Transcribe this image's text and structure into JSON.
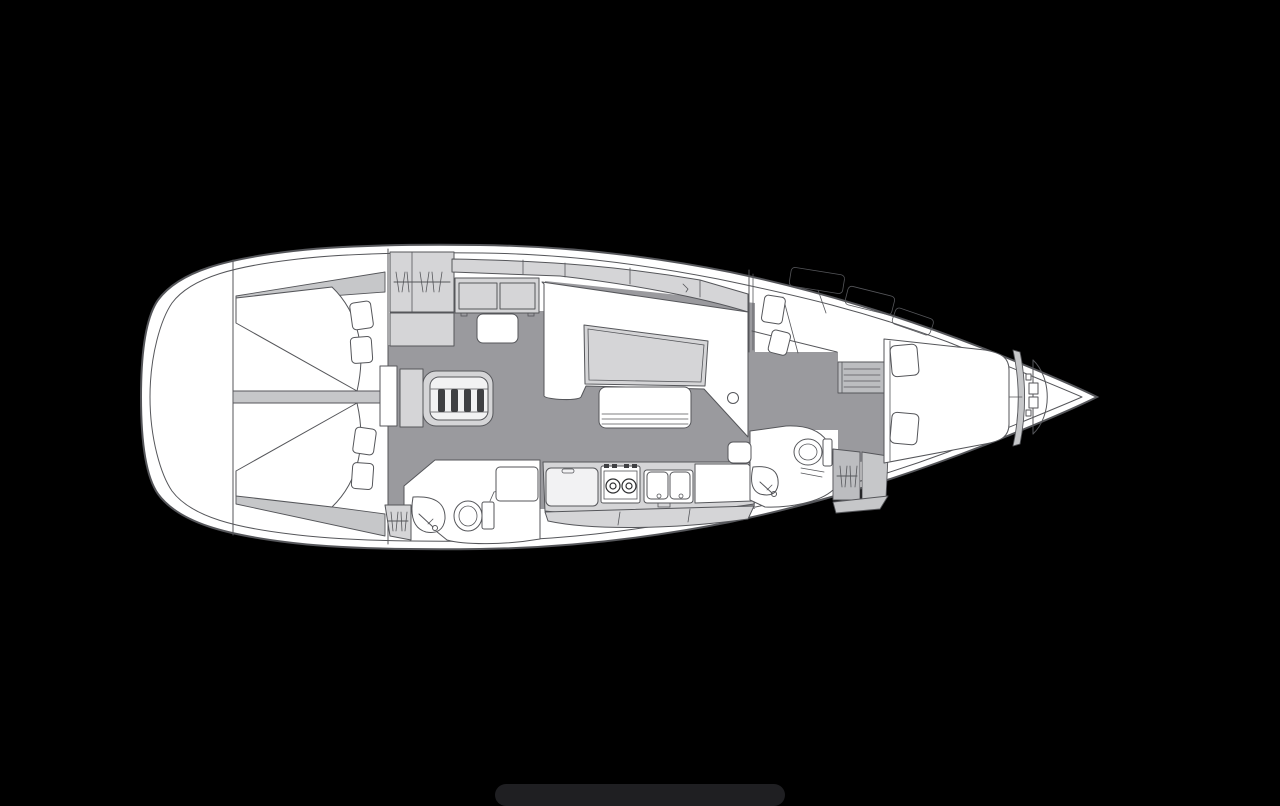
{
  "app": {
    "title": "Sailboat interior layout plan — top view, bow facing right"
  },
  "canvas": {
    "width": 1280,
    "height": 806,
    "background": "#000000"
  },
  "colors": {
    "bg": "#000000",
    "hull": "#ffffff",
    "line": "#55565a",
    "line-soft": "#8a8b8e",
    "floor": "#9a9a9e",
    "furn": "#d5d5d7",
    "panel": "#c6c7c9",
    "shelf": "#bcbdc0",
    "tread": "#3f4043",
    "inner": "#f2f2f3",
    "shadow": "#1f1f22"
  },
  "orientation": {
    "bow": "right",
    "stern": "left",
    "port": "top",
    "starboard": "bottom"
  },
  "rooms": [
    {
      "id": "stern-lazarette",
      "label": "stern locker / transom"
    },
    {
      "id": "aft-cabin-port",
      "label": "aft double cabin (port)"
    },
    {
      "id": "aft-cabin-starboard",
      "label": "aft double cabin (starboard)"
    },
    {
      "id": "aft-head",
      "label": "aft head with toilet and washbasin"
    },
    {
      "id": "salon",
      "label": "salon with L-settee and table"
    },
    {
      "id": "nav-station",
      "label": "chart table with seat"
    },
    {
      "id": "galley",
      "label": "galley with stove, double sink and fridge"
    },
    {
      "id": "forward-head",
      "label": "forward head with toilet and washbasin"
    },
    {
      "id": "forward-cabin",
      "label": "forward cabin with V-berth, sofa and vanity"
    },
    {
      "id": "anchor-locker",
      "label": "bow anchor locker"
    }
  ],
  "fixtures": [
    {
      "id": "double-berth-port",
      "label": "double berth with two pillows"
    },
    {
      "id": "double-berth-starboard",
      "label": "double berth with two pillows"
    },
    {
      "id": "companionway-steps",
      "label": "companionway steps (4 treads)"
    },
    {
      "id": "salon-table",
      "label": "salon table"
    },
    {
      "id": "center-bench",
      "label": "slatted bench seat"
    },
    {
      "id": "mast-post",
      "label": "mast post"
    },
    {
      "id": "stove-2-burner",
      "label": "two-burner stove"
    },
    {
      "id": "double-sink",
      "label": "double sink with taps"
    },
    {
      "id": "fridge",
      "label": "fridge / icebox"
    },
    {
      "id": "toilet-aft",
      "label": "marine toilet"
    },
    {
      "id": "toilet-forward",
      "label": "marine toilet"
    },
    {
      "id": "washbasin-aft",
      "label": "corner washbasin with faucet"
    },
    {
      "id": "washbasin-forward",
      "label": "corner washbasin with faucet"
    },
    {
      "id": "hanging-locker-port-aft",
      "label": "hanging locker (hanger symbol)"
    },
    {
      "id": "hanging-locker-starboard-aft",
      "label": "hanging locker (hanger symbol)"
    },
    {
      "id": "hanging-locker-forward",
      "label": "hanging locker (hanger symbol)"
    },
    {
      "id": "vanity-shelves",
      "label": "vanity / shelf unit"
    },
    {
      "id": "v-berth",
      "label": "V-berth with two pillows"
    }
  ]
}
